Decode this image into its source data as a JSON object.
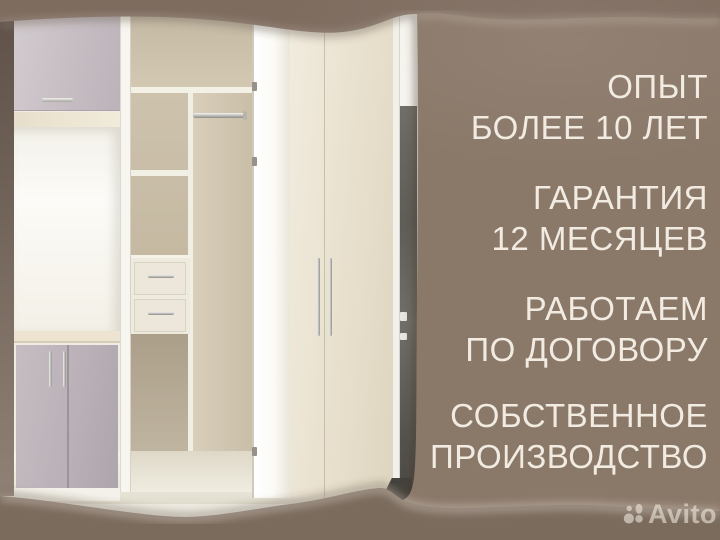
{
  "benefits": [
    {
      "lines": [
        "ОПЫТ",
        "БОЛЕЕ 10 ЛЕТ"
      ]
    },
    {
      "lines": [
        "ГАРАНТИЯ",
        "12 МЕСЯЦЕВ"
      ]
    },
    {
      "lines": [
        "РАБОТАЕМ",
        "ПО ДОГОВОРУ"
      ]
    },
    {
      "lines": [
        "СОБСТВЕННОЕ",
        "ПРОИЗВОДСТВО"
      ]
    }
  ],
  "watermark": {
    "brand": "Avito"
  },
  "colors": {
    "background_brown": "#8a7869",
    "band_shadow_brown": "#7a6a5e",
    "text_cream": "#f2ebe1",
    "watermark_gray": "rgba(242,235,224,0.58)",
    "photo_interior_beige": "#cfc4ae",
    "photo_door_cream": "#eae2d0",
    "photo_door_greige": "#c6bdc3",
    "photo_dark_doorframe": "#5f5d58"
  }
}
